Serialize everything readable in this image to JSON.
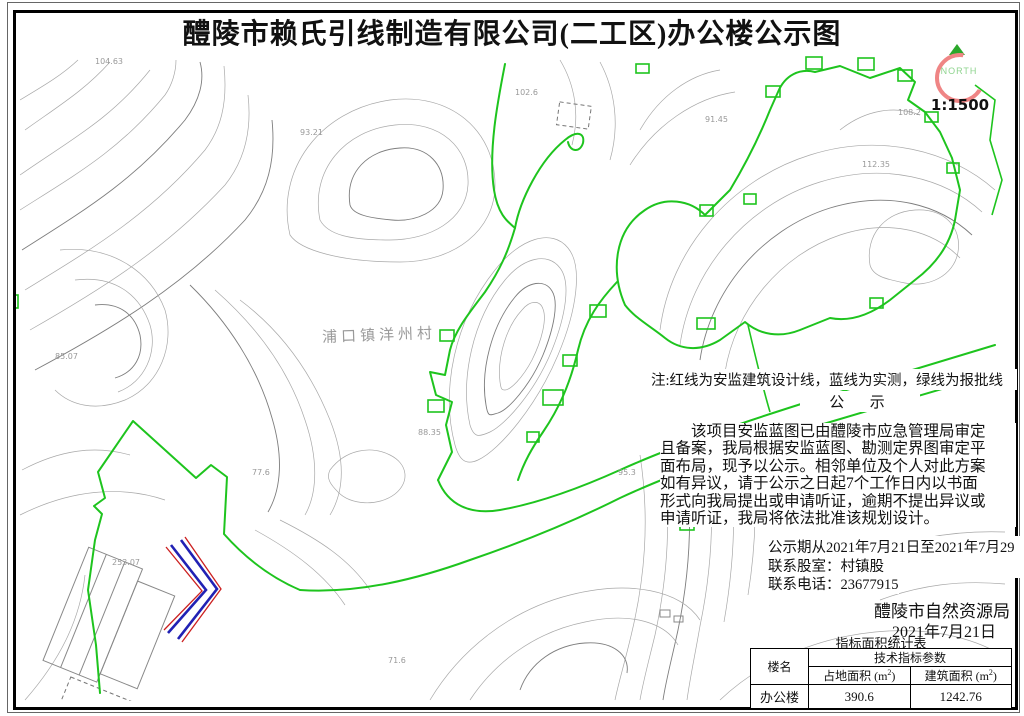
{
  "title": "醴陵市赖氏引线制造有限公司(二工区)办公楼公示图",
  "compass": {
    "north_label": "NORTH",
    "scale": "1:1500"
  },
  "legend_note": "注:红线为安监建筑设计线，蓝线为实测，绿线为报批线",
  "notice": {
    "heading": "公  示",
    "paragraph_lines": [
      "该项目安监蓝图已由醴陵市应急管理局审定",
      "且备案，我局根据安监蓝图、勘测定界图审定平",
      "面布局，现予以公示。相邻单位及个人对此方案",
      "如有异议，请于公示之日起7个工作日内以书面",
      "形式向我局提出或申请听证，逾期不提出异议或",
      "申请听证，我局将依法批准该规划设计。"
    ],
    "period_line": "公示期从2021年7月21日至2021年7月29日。",
    "contact_dept_line": "联系股室：村镇股",
    "contact_phone_line": "联系电话：23677915",
    "issuer": "醴陵市自然资源局",
    "issue_date": "2021年7月21日"
  },
  "table": {
    "title": "指标面积统计表",
    "col_building": "楼名",
    "col_params": "技术指标参数",
    "col_footprint": "占地面积 (m",
    "col_floor_area": "建筑面积 (m",
    "sup": "2",
    "close_paren": ")",
    "rows": [
      {
        "building": "办公楼",
        "footprint": "390.6",
        "floor_area": "1242.76"
      }
    ]
  },
  "map": {
    "village_label": "浦口镇洋州村",
    "elevation_labels": [
      "104.63",
      "93.21",
      "102.6",
      "91.45",
      "112.35",
      "108.2",
      "85.07",
      "77.6",
      "88.35",
      "95.3",
      "253.07",
      "71.6"
    ]
  },
  "colors": {
    "approval_line_green": "#1ec41e",
    "design_line_red": "#cc2020",
    "survey_line_blue": "#2121b4",
    "compass_ring_pink": "#ef8585",
    "compass_arrow_green": "#2aa82a",
    "contour_gray": "#a8a8a8"
  }
}
